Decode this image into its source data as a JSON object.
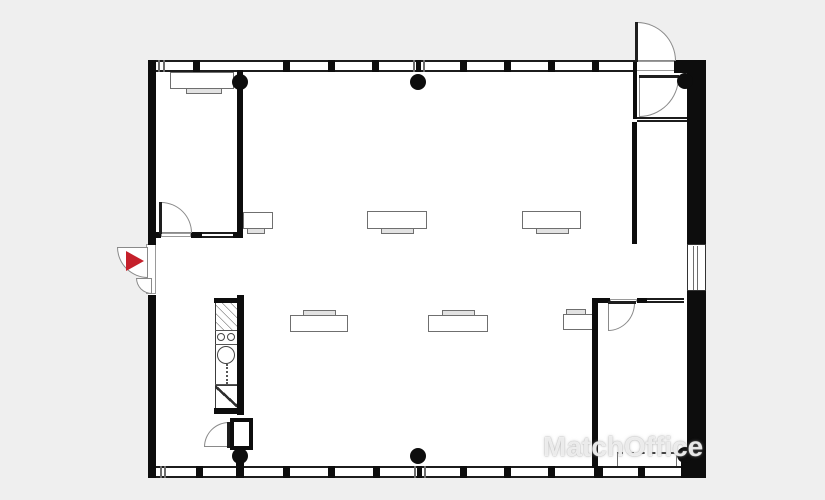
{
  "colors": {
    "background": "#efefef",
    "floor": "#ffffff",
    "wall": "#0d0d0d",
    "furniture_line": "#6f6f6f",
    "entrance_red": "#c5202b",
    "watermark": "rgba(255,255,255,0.8)"
  },
  "watermark": {
    "text": "MatchOffice",
    "x": 543,
    "y": 430,
    "logo": "building-pin"
  },
  "plan": {
    "floor": {
      "x": 148,
      "y": 60,
      "w": 558,
      "h": 418
    },
    "walls": [
      {
        "name": "left-wall-upper",
        "x": 148,
        "y": 60,
        "w": 8,
        "h": 185
      },
      {
        "name": "left-wall-lower",
        "x": 148,
        "y": 295,
        "w": 8,
        "h": 183
      },
      {
        "name": "top-wall-right-cap",
        "x": 674,
        "y": 60,
        "w": 32,
        "h": 13
      },
      {
        "name": "right-wall-upper",
        "x": 687,
        "y": 62,
        "w": 19,
        "h": 182
      },
      {
        "name": "right-wall-lower",
        "x": 687,
        "y": 291,
        "w": 19,
        "h": 187
      },
      {
        "name": "bottom-right-corner",
        "x": 681,
        "y": 448,
        "w": 25,
        "h": 30
      },
      {
        "name": "interior-wall-left",
        "x": 237,
        "y": 70,
        "w": 6,
        "h": 168
      },
      {
        "name": "room1-bottom-wall-a",
        "x": 148,
        "y": 232,
        "w": 13,
        "h": 6
      },
      {
        "name": "room1-bottom-wall-b",
        "x": 191,
        "y": 232,
        "w": 11,
        "h": 6
      },
      {
        "name": "room1-bottom-wall-c",
        "x": 233,
        "y": 232,
        "w": 10,
        "h": 6
      },
      {
        "name": "vestibule-left-wall",
        "x": 633,
        "y": 62,
        "w": 4,
        "h": 57
      },
      {
        "name": "interior-wall-right",
        "x": 632,
        "y": 122,
        "w": 5,
        "h": 122
      },
      {
        "name": "meeting-room-left-wall",
        "x": 592,
        "y": 298,
        "w": 6,
        "h": 170
      },
      {
        "name": "meeting-room-top-wall-a",
        "x": 592,
        "y": 298,
        "w": 18,
        "h": 5
      },
      {
        "name": "meeting-room-top-wall-b",
        "x": 637,
        "y": 298,
        "w": 10,
        "h": 5
      },
      {
        "name": "kitchen-wall-right",
        "x": 237,
        "y": 295,
        "w": 7,
        "h": 120
      },
      {
        "name": "kitchen-cap-top",
        "x": 214,
        "y": 298,
        "w": 30,
        "h": 5
      },
      {
        "name": "kitchen-cap-bottom",
        "x": 214,
        "y": 408,
        "w": 30,
        "h": 6
      },
      {
        "name": "column-stem",
        "x": 236,
        "y": 458,
        "w": 8,
        "h": 10
      }
    ],
    "windows": [
      {
        "name": "window-band-top",
        "x": 156,
        "y": 60,
        "w": 480,
        "h": 12,
        "o": "h"
      },
      {
        "name": "window-band-bottom",
        "x": 156,
        "y": 466,
        "w": 532,
        "h": 12,
        "o": "h"
      },
      {
        "name": "room1-window",
        "x": 202,
        "y": 232,
        "w": 31,
        "h": 6,
        "o": "h"
      },
      {
        "name": "vestibule-window",
        "x": 637,
        "y": 117,
        "w": 50,
        "h": 5,
        "o": "h"
      },
      {
        "name": "meeting-room-window",
        "x": 647,
        "y": 298,
        "w": 37,
        "h": 5,
        "o": "h"
      },
      {
        "name": "right-wall-window",
        "x": 687,
        "y": 244,
        "w": 19,
        "h": 47,
        "o": "v"
      }
    ],
    "mullions": [
      {
        "x": 158,
        "y": 60,
        "w": 2,
        "h": 12,
        "c": "gray"
      },
      {
        "x": 163,
        "y": 60,
        "w": 2,
        "h": 12,
        "c": "gray"
      },
      {
        "x": 193,
        "y": 60,
        "w": 7,
        "h": 12
      },
      {
        "x": 283,
        "y": 60,
        "w": 7,
        "h": 12
      },
      {
        "x": 328,
        "y": 60,
        "w": 7,
        "h": 12
      },
      {
        "x": 372,
        "y": 60,
        "w": 7,
        "h": 12
      },
      {
        "x": 413,
        "y": 60,
        "w": 2,
        "h": 12,
        "c": "gray"
      },
      {
        "x": 416,
        "y": 60,
        "w": 5,
        "h": 12
      },
      {
        "x": 423,
        "y": 60,
        "w": 2,
        "h": 12,
        "c": "gray"
      },
      {
        "x": 460,
        "y": 60,
        "w": 7,
        "h": 12
      },
      {
        "x": 504,
        "y": 60,
        "w": 7,
        "h": 12
      },
      {
        "x": 548,
        "y": 60,
        "w": 7,
        "h": 12
      },
      {
        "x": 592,
        "y": 60,
        "w": 7,
        "h": 12
      },
      {
        "x": 160,
        "y": 466,
        "w": 2,
        "h": 12,
        "c": "gray"
      },
      {
        "x": 164,
        "y": 466,
        "w": 2,
        "h": 12,
        "c": "gray"
      },
      {
        "x": 196,
        "y": 466,
        "w": 7,
        "h": 12
      },
      {
        "x": 236,
        "y": 466,
        "w": 8,
        "h": 12
      },
      {
        "x": 283,
        "y": 466,
        "w": 7,
        "h": 12
      },
      {
        "x": 328,
        "y": 466,
        "w": 7,
        "h": 12
      },
      {
        "x": 373,
        "y": 466,
        "w": 7,
        "h": 12
      },
      {
        "x": 414,
        "y": 466,
        "w": 2,
        "h": 12,
        "c": "gray"
      },
      {
        "x": 417,
        "y": 466,
        "w": 5,
        "h": 12
      },
      {
        "x": 424,
        "y": 466,
        "w": 2,
        "h": 12,
        "c": "gray"
      },
      {
        "x": 460,
        "y": 466,
        "w": 7,
        "h": 12
      },
      {
        "x": 504,
        "y": 466,
        "w": 7,
        "h": 12
      },
      {
        "x": 548,
        "y": 466,
        "w": 7,
        "h": 12
      },
      {
        "x": 594,
        "y": 466,
        "w": 9,
        "h": 12
      },
      {
        "x": 638,
        "y": 466,
        "w": 7,
        "h": 12
      },
      {
        "x": 693,
        "y": 246,
        "w": 1,
        "h": 44,
        "c": "gray"
      },
      {
        "x": 697,
        "y": 246,
        "w": 1,
        "h": 44,
        "c": "gray"
      }
    ],
    "thresholds": [
      {
        "name": "north-exit-threshold",
        "x": 636,
        "y": 61,
        "w": 39,
        "h": 10
      },
      {
        "name": "room1-door-threshold",
        "x": 161,
        "y": 233,
        "w": 30,
        "h": 4
      },
      {
        "name": "meeting-door-threshold",
        "x": 610,
        "y": 299,
        "w": 27,
        "h": 3
      },
      {
        "name": "entrance-threshold",
        "x": 146,
        "y": 244,
        "w": 10,
        "h": 50
      }
    ],
    "doors": [
      {
        "name": "entrance-door",
        "x": 117,
        "y": 247,
        "w": 31,
        "h": 31,
        "round": "bl"
      },
      {
        "name": "entrance-door-small",
        "x": 136,
        "y": 278,
        "w": 16,
        "h": 16,
        "round": "bl"
      },
      {
        "name": "room1-door",
        "x": 161,
        "y": 202,
        "w": 31,
        "h": 31,
        "round": "tr"
      },
      {
        "name": "north-exit-door",
        "x": 637,
        "y": 22,
        "w": 39,
        "h": 39,
        "round": "tr"
      },
      {
        "name": "vestibule-door",
        "x": 639,
        "y": 77,
        "w": 40,
        "h": 40,
        "round": "br"
      },
      {
        "name": "meeting-room-door",
        "x": 608,
        "y": 303,
        "w": 27,
        "h": 28,
        "round": "br"
      },
      {
        "name": "storage-door",
        "x": 204,
        "y": 422,
        "w": 25,
        "h": 25,
        "round": "tl"
      }
    ],
    "leaves": [
      {
        "name": "room1-door-leaf",
        "x": 159,
        "y": 202,
        "w": 3,
        "h": 32
      },
      {
        "name": "north-exit-door-leaf",
        "x": 635,
        "y": 22,
        "w": 3,
        "h": 40
      },
      {
        "name": "vestibule-door-leaf",
        "x": 639,
        "y": 75,
        "w": 40,
        "h": 3
      },
      {
        "name": "meeting-room-door-leaf",
        "x": 608,
        "y": 301,
        "w": 28,
        "h": 3
      },
      {
        "name": "storage-door-leaf",
        "x": 227,
        "y": 422,
        "w": 3,
        "h": 26
      }
    ],
    "columns": [
      {
        "cx": 240,
        "cy": 82,
        "r": 8
      },
      {
        "cx": 418,
        "cy": 82,
        "r": 8
      },
      {
        "cx": 685,
        "cy": 81,
        "r": 8
      },
      {
        "cx": 240,
        "cy": 456,
        "r": 8
      },
      {
        "cx": 418,
        "cy": 456,
        "r": 8
      },
      {
        "cx": 685,
        "cy": 455,
        "r": 8
      }
    ],
    "desks": [
      {
        "name": "desk-top-left",
        "x": 170,
        "y": 72,
        "w": 64,
        "h": 17,
        "notch": "bottom",
        "nx": 186,
        "nw": 36
      },
      {
        "name": "desk-row1-left",
        "x": 243,
        "y": 212,
        "w": 30,
        "h": 17,
        "notch": "bottom",
        "nx": 247,
        "nw": 18
      },
      {
        "name": "desk-row1-mid",
        "x": 367,
        "y": 211,
        "w": 60,
        "h": 18,
        "notch": "bottom",
        "nx": 381,
        "nw": 33
      },
      {
        "name": "desk-row1-right",
        "x": 522,
        "y": 211,
        "w": 59,
        "h": 18,
        "notch": "bottom",
        "nx": 536,
        "nw": 33
      },
      {
        "name": "desk-row2-left",
        "x": 290,
        "y": 315,
        "w": 58,
        "h": 17,
        "notch": "top",
        "nx": 303,
        "nw": 33
      },
      {
        "name": "desk-row2-mid",
        "x": 428,
        "y": 315,
        "w": 60,
        "h": 17,
        "notch": "top",
        "nx": 442,
        "nw": 33
      },
      {
        "name": "desk-row2-right",
        "x": 563,
        "y": 314,
        "w": 32,
        "h": 16,
        "notch": "top",
        "nx": 566,
        "nw": 20
      },
      {
        "name": "desk-meeting-room",
        "x": 617,
        "y": 452,
        "w": 60,
        "h": 16,
        "notch": "none",
        "dashed": true
      }
    ],
    "kitchen": {
      "unit": {
        "x": 215,
        "y": 301,
        "w": 24,
        "h": 108
      },
      "hatch": {
        "x": 216,
        "y": 302,
        "w": 22,
        "h": 28
      },
      "dividers": [
        {
          "x": 215,
          "y": 330,
          "w": 24,
          "h": 1
        },
        {
          "x": 215,
          "y": 344,
          "w": 24,
          "h": 1
        },
        {
          "x": 215,
          "y": 384,
          "w": 24,
          "h": 1
        }
      ],
      "circles": [
        {
          "cx": 221,
          "cy": 337,
          "r": 4
        },
        {
          "cx": 231,
          "cy": 337,
          "r": 4
        },
        {
          "cx": 226,
          "cy": 355,
          "r": 9
        }
      ],
      "dotted": {
        "x": 226,
        "y": 364,
        "h": 20
      },
      "zigzag": {
        "x": 215,
        "y": 385,
        "w": 24,
        "h": 23
      }
    },
    "wc_box": {
      "x": 230,
      "y": 418,
      "w": 23,
      "h": 32
    },
    "entrance_marker": {
      "x": 126,
      "y": 251,
      "size": 18
    }
  }
}
